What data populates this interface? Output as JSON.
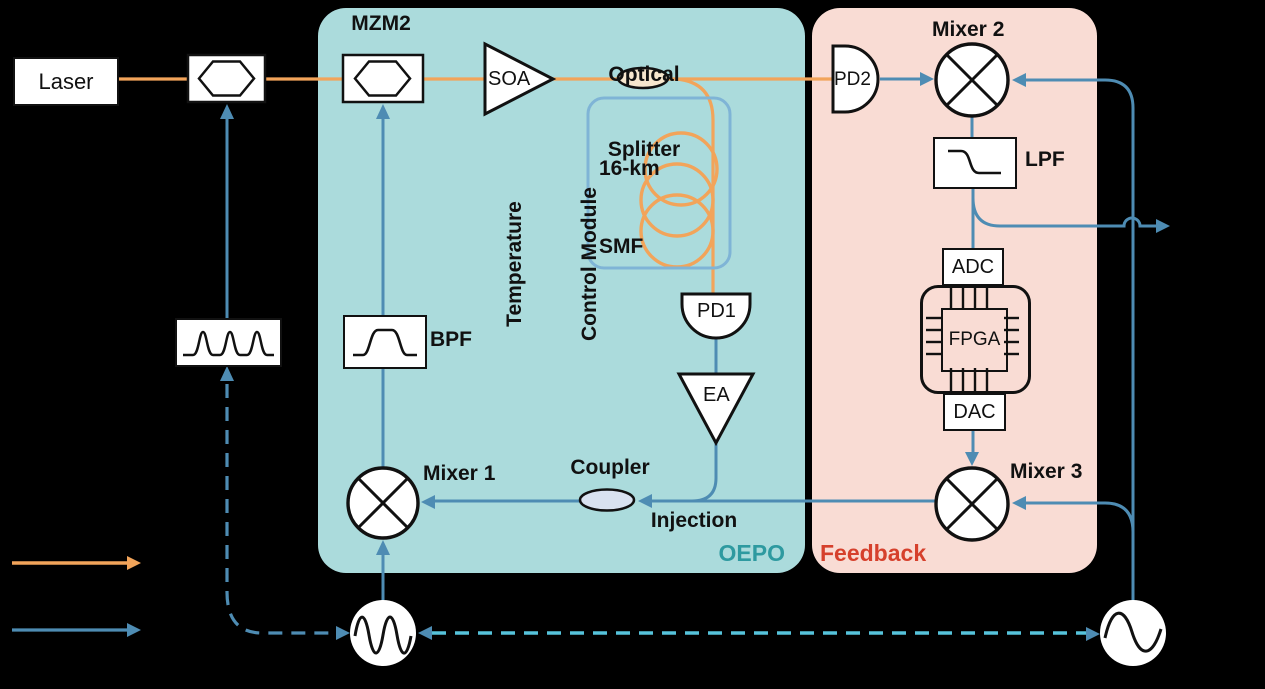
{
  "figure_type": "optoelectronic-oscillator-block-diagram",
  "labels": {
    "laser": "Laser",
    "mzm2": "MZM2",
    "soa": "SOA",
    "splitter1": "Optical",
    "splitter2": "Splitter",
    "smf1": "16-km",
    "smf2": "SMF",
    "tcm1": "Temperature",
    "tcm2": "Control Module",
    "pd1": "PD1",
    "pd2": "PD2",
    "ea": "EA",
    "bpf": "BPF",
    "lpf": "LPF",
    "mixer1": "Mixer 1",
    "mixer2": "Mixer 2",
    "mixer3": "Mixer 3",
    "coupler": "Coupler",
    "injection": "Injection",
    "adc": "ADC",
    "fpga": "FPGA",
    "dac": "DAC",
    "oepo": "OEPO",
    "feedback": "Feedback"
  },
  "colors": {
    "optical_path": "#F2A45A",
    "electrical_path": "#4E8CB3",
    "sync_dashed": "#56C3DB",
    "oepo_region_fill": "#ABDBDC",
    "feedback_region_fill": "#F9DCD4",
    "oepo_label_color": "#2E9AA0",
    "feedback_label_color": "#D6402C",
    "tcm_border": "#7FB4D6",
    "splitter_fill": "#F7E7CE",
    "coupler_fill": "#D9E2F0"
  }
}
